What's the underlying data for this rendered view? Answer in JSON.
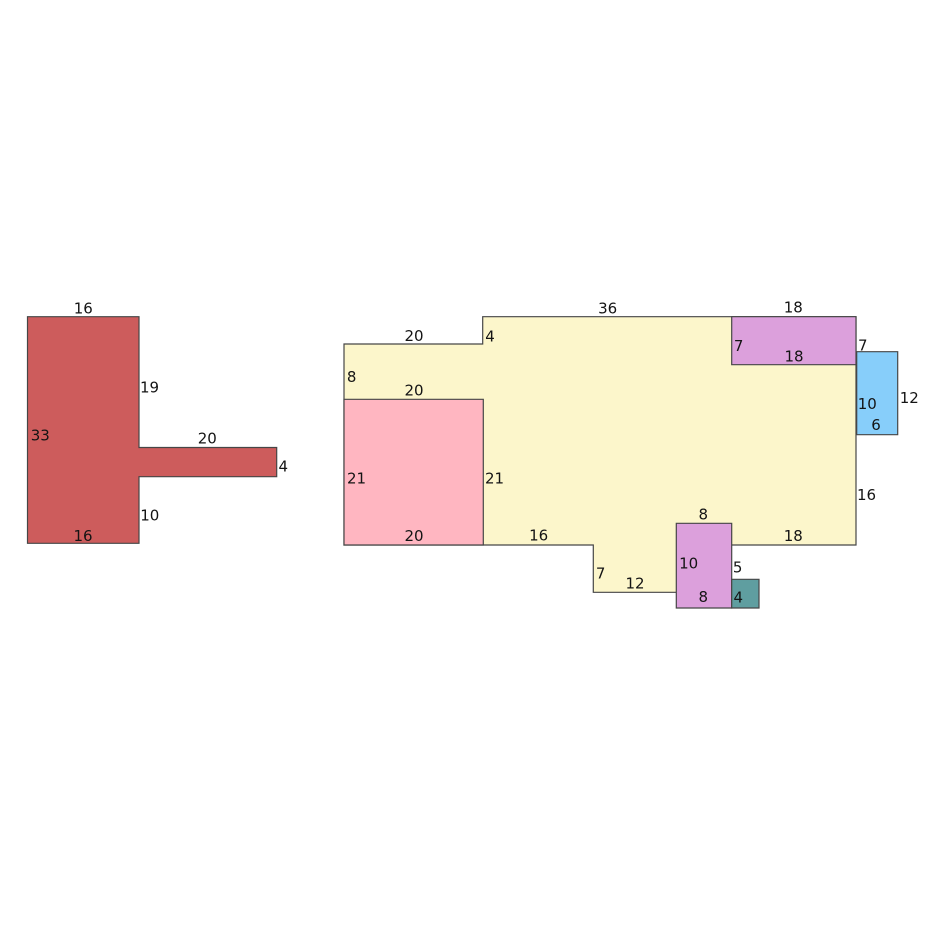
{
  "canvas": {
    "width": 925,
    "height": 925,
    "background": "#ffffff",
    "stroke_color": "#464646",
    "stroke_width": 1.2,
    "label_color": "#141414",
    "label_font_size": 15
  },
  "diagram": {
    "kind": "rectilinear-shapes-with-dimension-labels",
    "shapes": [
      {
        "id": "red-t-piece",
        "fill": "#CD5C5C",
        "points": [
          [
            27.5,
            316.7
          ],
          [
            139,
            316.7
          ],
          [
            139,
            447.5
          ],
          [
            276.7,
            447.5
          ],
          [
            276.7,
            476.7
          ],
          [
            139,
            476.7
          ],
          [
            139,
            543.3
          ],
          [
            27.5,
            543.3
          ]
        ],
        "labels": [
          {
            "text": "16",
            "x": 83.3,
            "y": 308.3
          },
          {
            "text": "19",
            "x": 149.5,
            "y": 387.3
          },
          {
            "text": "33",
            "x": 40.3,
            "y": 435.3
          },
          {
            "text": "20",
            "x": 207.3,
            "y": 438.6
          },
          {
            "text": "4",
            "x": 283.3,
            "y": 466.7
          },
          {
            "text": "10",
            "x": 149.8,
            "y": 515.3
          },
          {
            "text": "16",
            "x": 83.0,
            "y": 536.0
          }
        ]
      },
      {
        "id": "yellow-container",
        "fill": "#FCF6CB",
        "points": [
          [
            344,
            344
          ],
          [
            482.7,
            344
          ],
          [
            482.7,
            316.7
          ],
          [
            856,
            316.7
          ],
          [
            856,
            545
          ],
          [
            690,
            545
          ],
          [
            690,
            592.3
          ],
          [
            593.3,
            592.3
          ],
          [
            593.3,
            545
          ],
          [
            344,
            545
          ]
        ],
        "labels": [
          {
            "text": "20",
            "x": 414.0,
            "y": 336.0
          },
          {
            "text": "4",
            "x": 490.0,
            "y": 336.7
          },
          {
            "text": "36",
            "x": 607.7,
            "y": 308.3
          },
          {
            "text": "8",
            "x": 351.7,
            "y": 377.0
          },
          {
            "text": "16",
            "x": 538.7,
            "y": 535.7
          },
          {
            "text": "7",
            "x": 600.7,
            "y": 573.3
          },
          {
            "text": "12",
            "x": 635.0,
            "y": 583.6
          },
          {
            "text": "18",
            "x": 793.3,
            "y": 536.0
          },
          {
            "text": "16",
            "x": 866.5,
            "y": 495.0
          }
        ]
      },
      {
        "id": "pink-square-piece",
        "fill": "#FFB6C1",
        "points": [
          [
            344,
            399.3
          ],
          [
            483.3,
            399.3
          ],
          [
            483.3,
            545
          ],
          [
            344,
            545
          ]
        ],
        "labels": [
          {
            "text": "20",
            "x": 414.0,
            "y": 390.3
          },
          {
            "text": "21",
            "x": 356.5,
            "y": 478.3
          },
          {
            "text": "21",
            "x": 494.5,
            "y": 478.7
          },
          {
            "text": "20",
            "x": 414.0,
            "y": 536.0
          }
        ]
      },
      {
        "id": "purple-top-piece",
        "fill": "#DCA0DC",
        "points": [
          [
            731.7,
            316.7
          ],
          [
            856,
            316.7
          ],
          [
            856,
            364.7
          ],
          [
            731.7,
            364.7
          ]
        ],
        "labels": [
          {
            "text": "18",
            "x": 793.3,
            "y": 307.7
          },
          {
            "text": "7",
            "x": 738.7,
            "y": 346.0
          },
          {
            "text": "18",
            "x": 794.0,
            "y": 356.7
          },
          {
            "text": "7",
            "x": 862.8,
            "y": 345.3
          }
        ]
      },
      {
        "id": "blue-piece",
        "fill": "#87CEFA",
        "points": [
          [
            856.7,
            351.7
          ],
          [
            897.7,
            351.7
          ],
          [
            897.7,
            434.7
          ],
          [
            856.7,
            434.7
          ]
        ],
        "labels": [
          {
            "text": "10",
            "x": 867.3,
            "y": 404.0
          },
          {
            "text": "6",
            "x": 876.0,
            "y": 425.0
          },
          {
            "text": "12",
            "x": 909.3,
            "y": 398.0
          }
        ]
      },
      {
        "id": "purple-bottom-piece",
        "fill": "#DCA0DC",
        "points": [
          [
            676.3,
            523.3
          ],
          [
            731.7,
            523.3
          ],
          [
            731.7,
            608
          ],
          [
            676.3,
            608
          ]
        ],
        "labels": [
          {
            "text": "8",
            "x": 703.3,
            "y": 514.3
          },
          {
            "text": "10",
            "x": 688.7,
            "y": 563.3
          },
          {
            "text": "8",
            "x": 703.3,
            "y": 597.0
          },
          {
            "text": "5",
            "x": 737.7,
            "y": 567.7
          }
        ]
      },
      {
        "id": "teal-square-piece",
        "fill": "#5F9EA0",
        "points": [
          [
            731.7,
            579.3
          ],
          [
            759,
            579.3
          ],
          [
            759,
            608
          ],
          [
            731.7,
            608
          ]
        ],
        "labels": [
          {
            "text": "4",
            "x": 738.3,
            "y": 597.3
          }
        ]
      }
    ]
  }
}
